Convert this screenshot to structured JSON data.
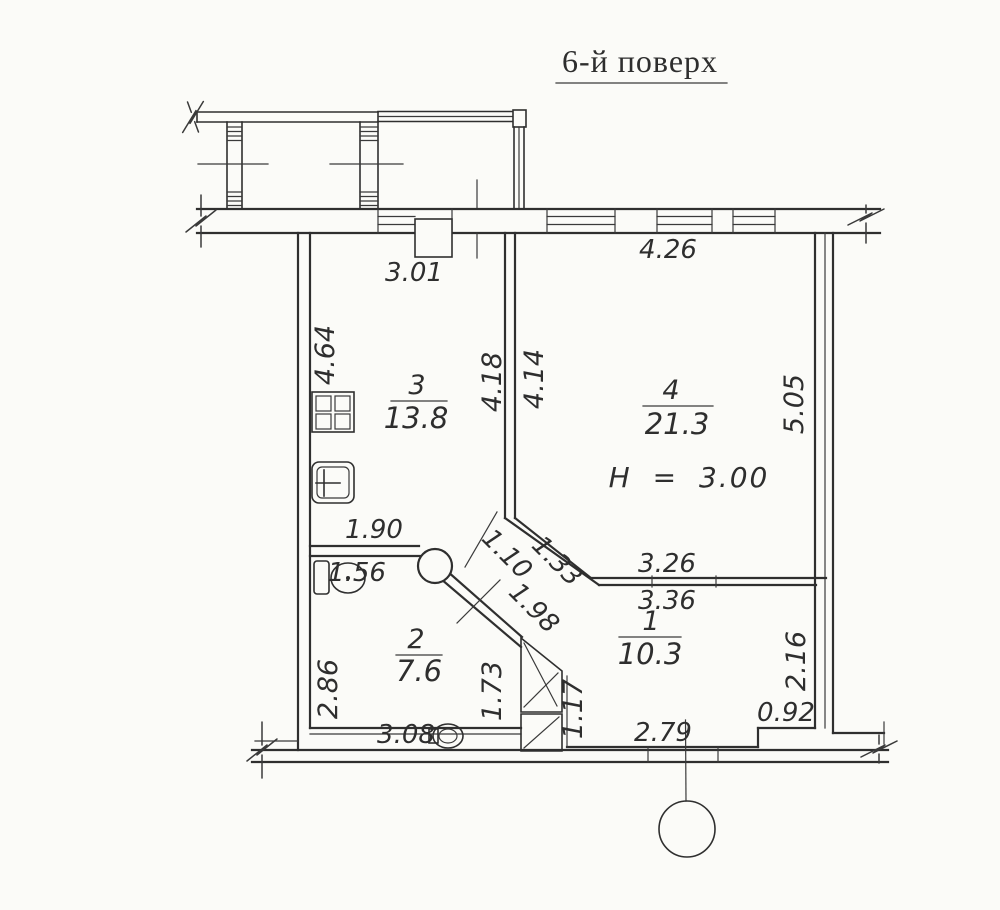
{
  "title": "6-й поверх",
  "rooms": {
    "r1": {
      "number": "1",
      "area": "10.3"
    },
    "r2": {
      "number": "2",
      "area": "7.6"
    },
    "r3": {
      "number": "3",
      "area": "13.8"
    },
    "r4": {
      "number": "4",
      "area": "21.3"
    }
  },
  "ceiling_height": "H = 3.00",
  "dims": {
    "kitchen_window": "3.01",
    "living_window": "4.26",
    "kitchen_left": "4.64",
    "kitchen_right": "4.18",
    "living_left": "4.14",
    "living_right": "5.05",
    "bath_top": "1.90",
    "toilet_width": "1.56",
    "hall_width": "1.10",
    "hall_opening": "1.33",
    "hall_wall": "1.98",
    "living_bottom": "3.26",
    "room1_top": "3.36",
    "bath_left": "2.86",
    "bath_right": "1.73",
    "shaft_side": "1.17",
    "room1_right": "2.16",
    "bath_bottom": "3.08",
    "room1_bottom": "2.79",
    "corner_step": "0.92"
  },
  "colors": {
    "line": "#2f2f2f",
    "text": "#2e2e2e",
    "paper": "#fbfbf8"
  }
}
